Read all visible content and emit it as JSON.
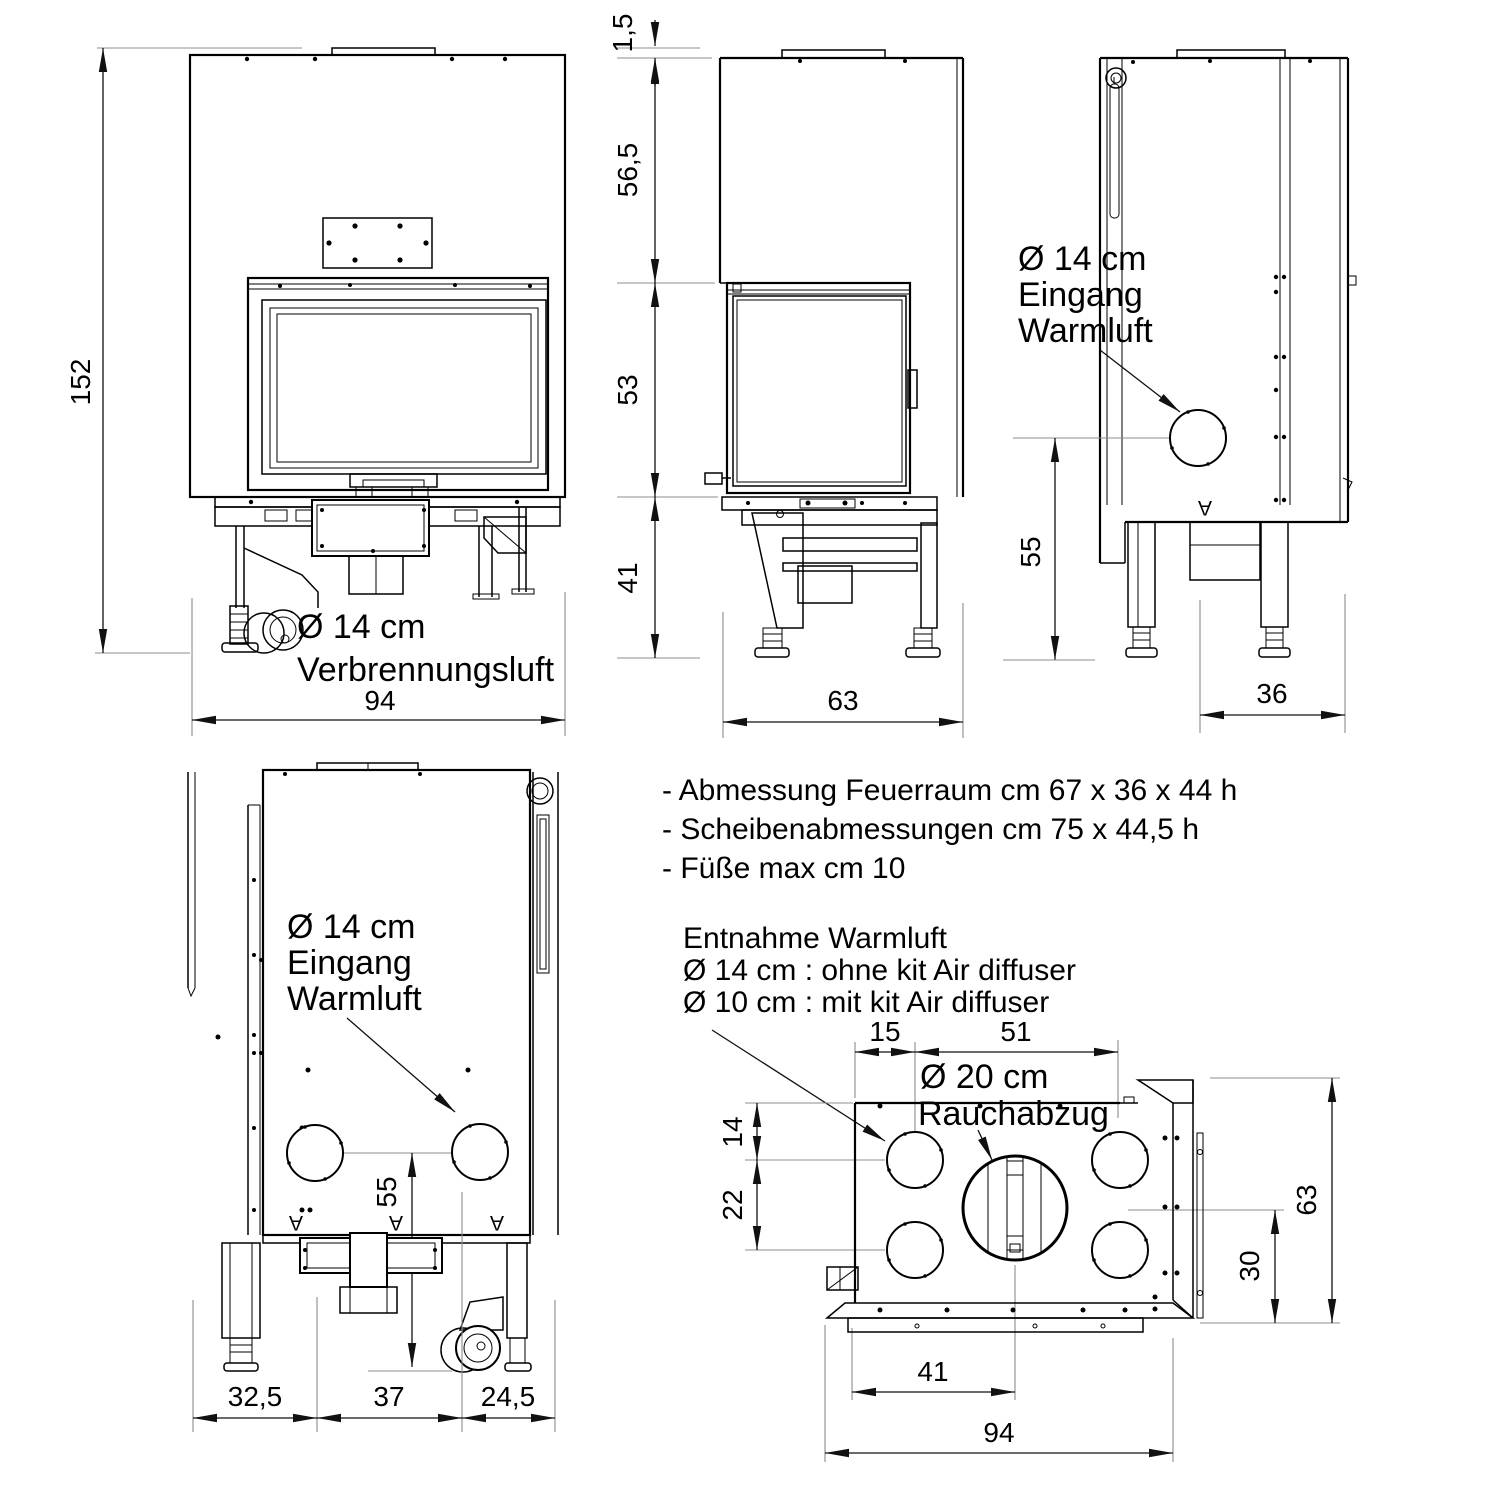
{
  "drawing": {
    "background": "#ffffff",
    "line_color": "#000000",
    "dim_line_color": "#111111",
    "extension_line_color": "#8c8c8c"
  },
  "notes": {
    "spec_items": [
      "- Abmessung Feuerraum cm 67 x 36 x 44 h",
      "- Scheibenabmessungen cm 75 x 44,5 h",
      "- Füße max cm 10"
    ],
    "warm_air_extraction": {
      "title": "Entnahme Warmluft",
      "option_without_kit": "Ø 14 cm : ohne kit Air diffuser",
      "option_with_kit": "Ø 10 cm : mit kit Air diffuser"
    }
  },
  "front_view": {
    "overall_height": "152",
    "overall_width": "94",
    "combustion_air": {
      "line1": "Ø 14 cm",
      "line2": "Verbrennungsluft"
    }
  },
  "side_view": {
    "top_plate": "1,5",
    "hood_height": "56,5",
    "door_height": "53",
    "base_height": "41",
    "depth": "63"
  },
  "right_side_view": {
    "warm_air_inlet": {
      "line1": "Ø 14 cm",
      "line2": "Eingang",
      "line3": "Warmluft"
    },
    "inlet_height": "55",
    "rear_depth": "36",
    "section_mark": "A"
  },
  "rear_view": {
    "warm_air_inlet": {
      "line1": "Ø 14 cm",
      "line2": "Eingang",
      "line3": "Warmluft"
    },
    "inlet_height": "55",
    "left_offset": "32,5",
    "center_span": "37",
    "right_offset": "24,5",
    "section_mark": "A"
  },
  "top_view": {
    "front_offset": "15",
    "smoke_offset": "51",
    "smoke_outlet": {
      "line1": "Ø 20 cm",
      "line2": "Rauchabzug"
    },
    "inlet_front_offset": "14",
    "inlet_spacing": "22",
    "depth": "63",
    "rear_span": "30",
    "smoke_center_offset": "41",
    "overall_width": "94"
  }
}
